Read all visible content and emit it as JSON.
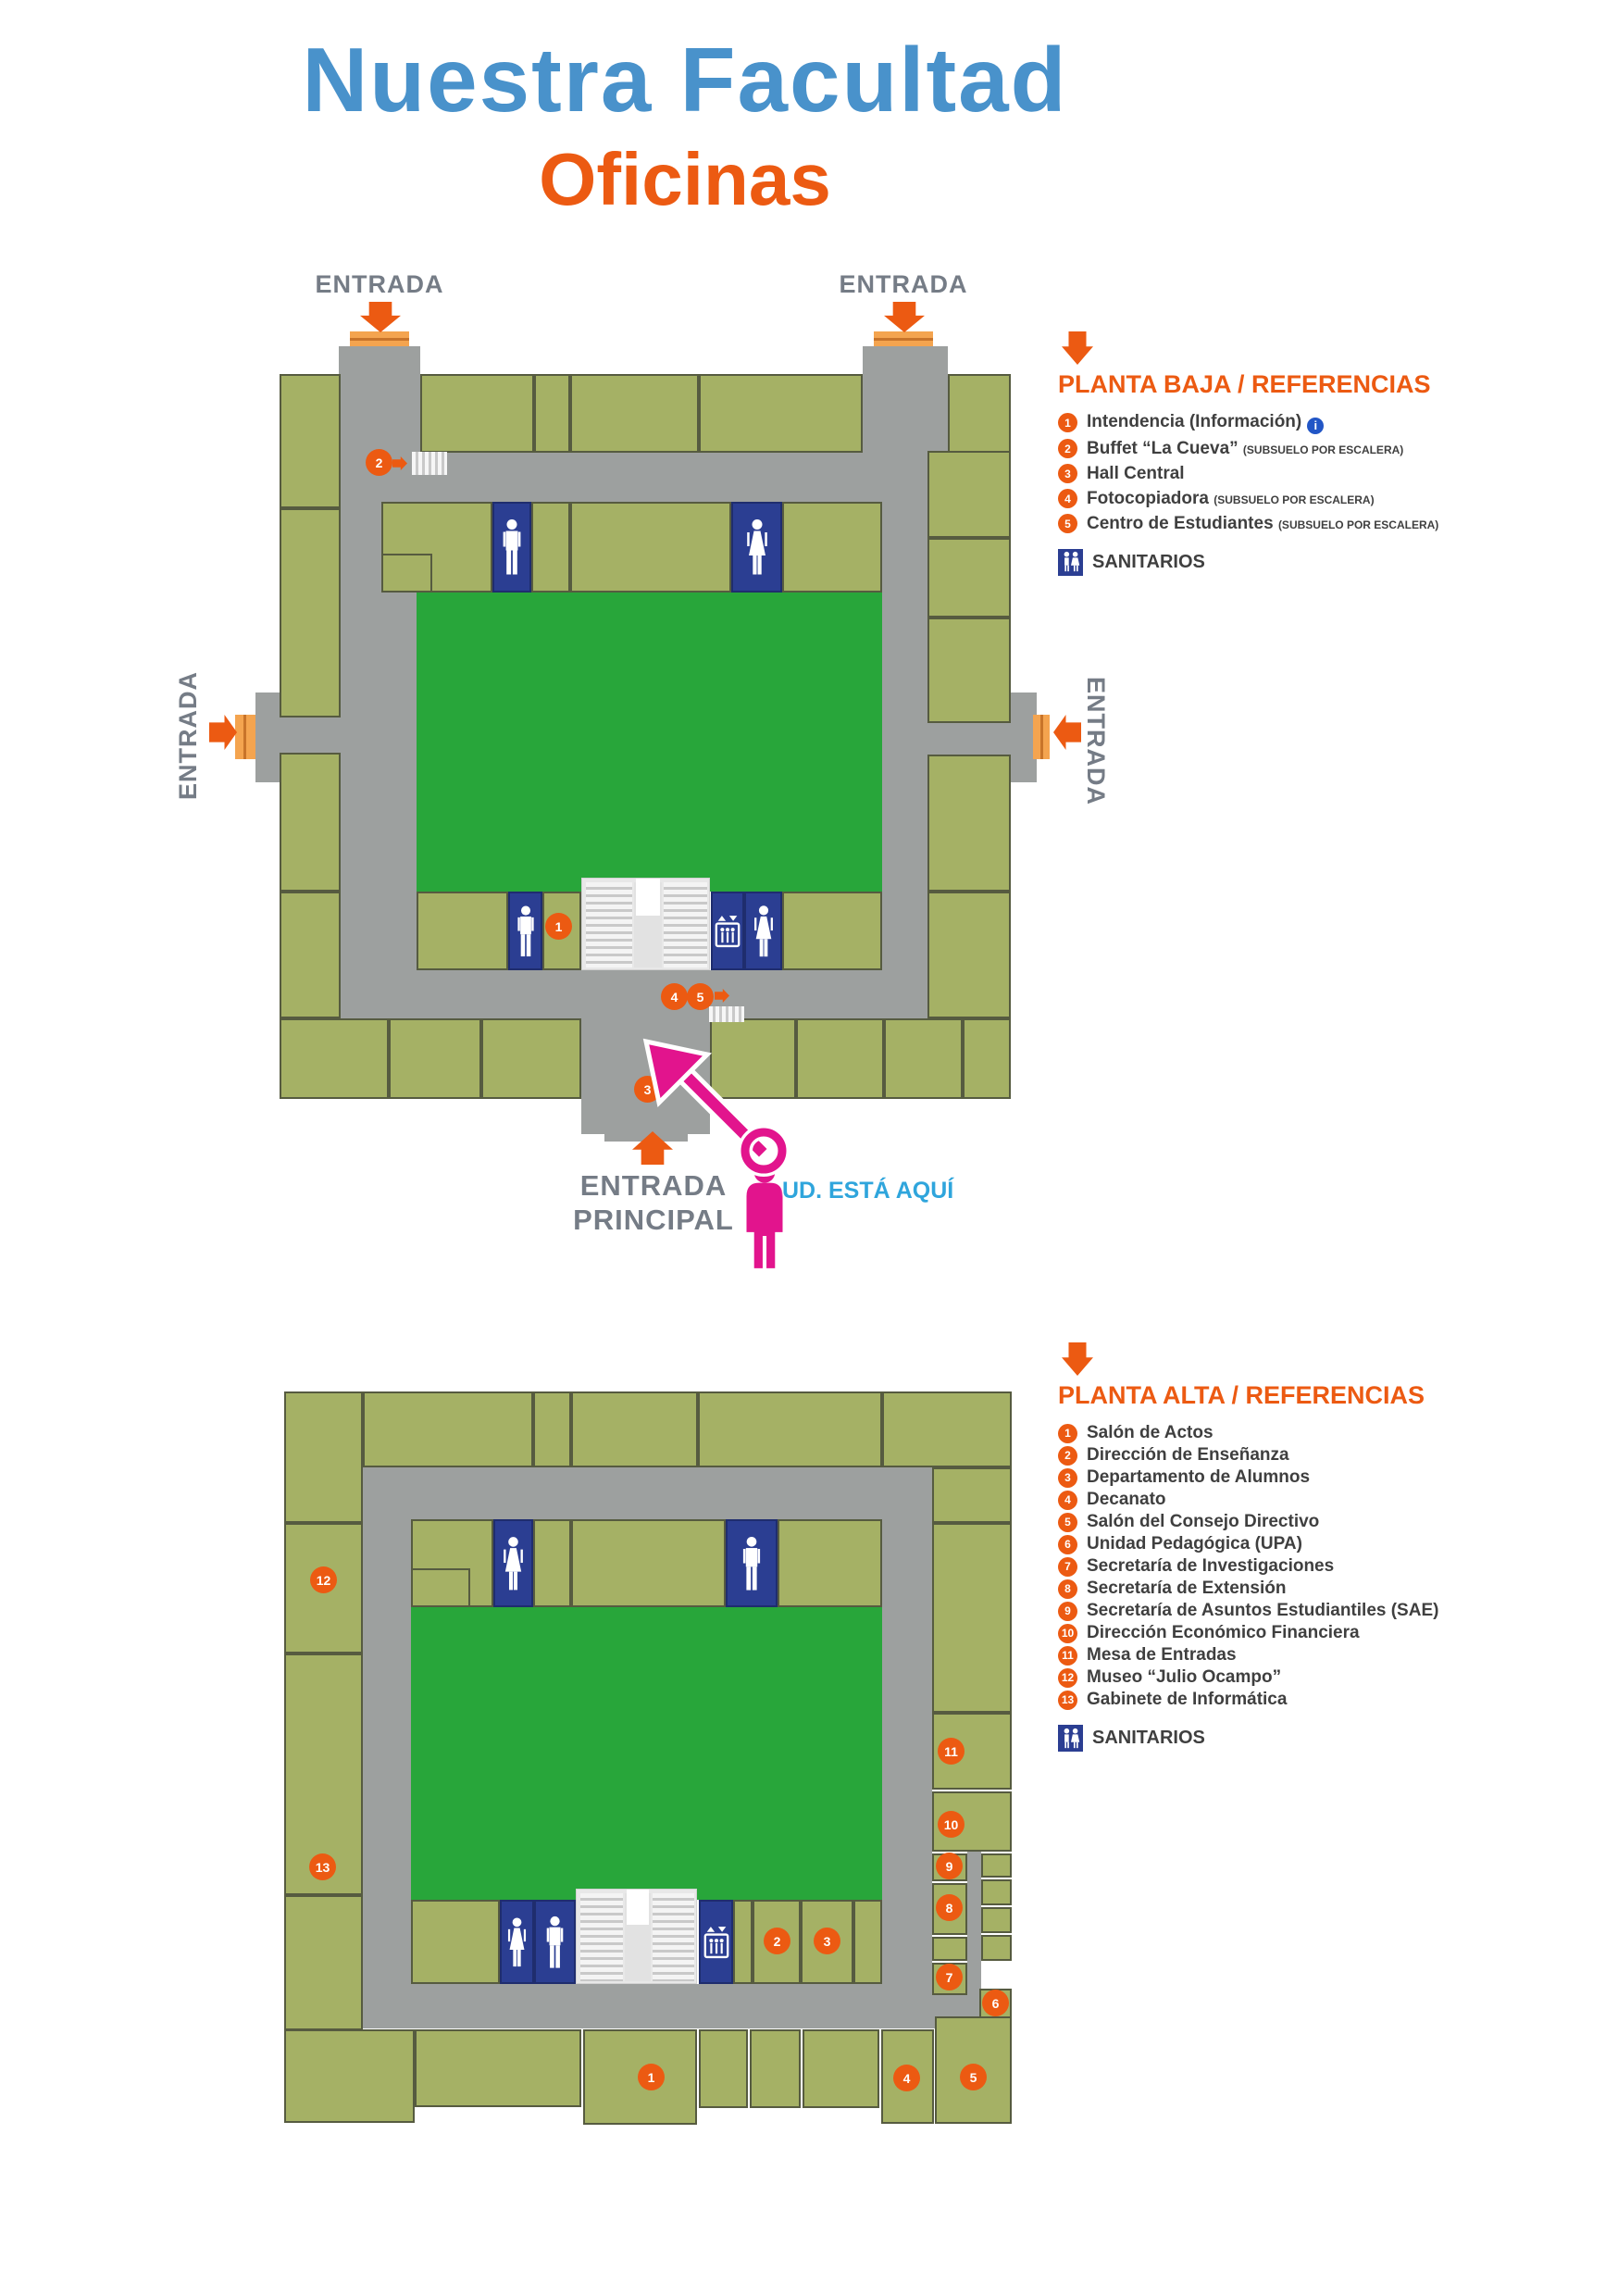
{
  "page": {
    "title": "Nuestra Facultad",
    "subtitle": "Oficinas"
  },
  "labels": {
    "entrada": "ENTRADA",
    "principal": "PRINCIPAL",
    "you_are_here": "UD. ESTÁ AQUÍ",
    "sanitarios": "SANITARIOS"
  },
  "icons": {
    "info_glyph": "i"
  },
  "colors": {
    "title_blue": "#4992CB",
    "accent_orange": "#EC5A12",
    "door_orange": "#F4A44F",
    "corridor_gray": "#9DA09F",
    "room_olive": "#A5B165",
    "courtyard_green": "#28A63A",
    "wc_blue": "#2B3E92",
    "magenta": "#E2148D",
    "you_are_here_blue": "#2FA5DC",
    "entrance_text_gray": "#757C86",
    "legend_text": "#3F3F3F"
  },
  "planta_baja": {
    "legend_title": "PLANTA BAJA / REFERENCIAS",
    "items": [
      {
        "n": "1",
        "label": "Intendencia (Información)"
      },
      {
        "n": "2",
        "label": "Buffet “La Cueva”",
        "note": "(SUBSUELO POR ESCALERA)"
      },
      {
        "n": "3",
        "label": "Hall Central"
      },
      {
        "n": "4",
        "label": "Fotocopiadora",
        "note": "(SUBSUELO POR ESCALERA)"
      },
      {
        "n": "5",
        "label": "Centro de Estudiantes",
        "note": "(SUBSUELO POR ESCALERA)"
      }
    ],
    "map_markers": [
      "2",
      "1",
      "4",
      "5",
      "3"
    ]
  },
  "planta_alta": {
    "legend_title": "PLANTA ALTA / REFERENCIAS",
    "items": [
      {
        "n": "1",
        "label": "Salón de Actos"
      },
      {
        "n": "2",
        "label": "Dirección de Enseñanza"
      },
      {
        "n": "3",
        "label": "Departamento de Alumnos"
      },
      {
        "n": "4",
        "label": "Decanato"
      },
      {
        "n": "5",
        "label": "Salón del Consejo Directivo"
      },
      {
        "n": "6",
        "label": "Unidad Pedagógica (UPA)"
      },
      {
        "n": "7",
        "label": "Secretaría de Investigaciones"
      },
      {
        "n": "8",
        "label": "Secretaría de Extensión"
      },
      {
        "n": "9",
        "label": "Secretaría de Asuntos Estudiantiles (SAE)"
      },
      {
        "n": "10",
        "label": "Dirección Económico Financiera"
      },
      {
        "n": "11",
        "label": "Mesa de Entradas"
      },
      {
        "n": "12",
        "label": "Museo “Julio Ocampo”"
      },
      {
        "n": "13",
        "label": "Gabinete de Informática"
      }
    ],
    "map_markers": [
      "12",
      "13",
      "11",
      "10",
      "9",
      "8",
      "7",
      "6",
      "2",
      "3",
      "1",
      "4",
      "5"
    ]
  }
}
